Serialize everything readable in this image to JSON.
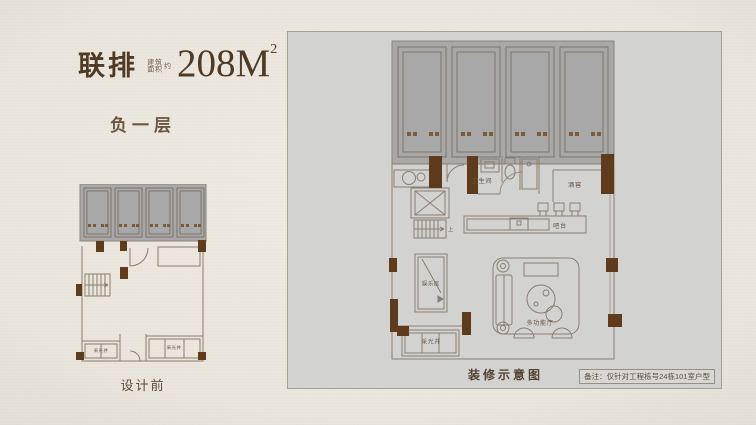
{
  "header": {
    "title": "联排",
    "area_label_line1": "建筑",
    "area_label_line2": "面积",
    "area_label_suffix": "约",
    "area_value": "208M",
    "area_sup": "2",
    "floor": "负一层"
  },
  "before_plan": {
    "caption": "设计前",
    "light_well_left": "采光井",
    "light_well_right": "采光井"
  },
  "after_plan": {
    "caption": "装修示意图",
    "note": "备注：仅针对工程栋号24栋101室户型",
    "rooms": {
      "bathroom": "卫生间",
      "wine_cellar": "酒窖",
      "bar": "吧台",
      "stairs_up": "上",
      "entertainment": "娱乐区",
      "multi_function": "多功能厅",
      "light_well": "采光井"
    }
  },
  "colors": {
    "background": "#e9e5dc",
    "panel_bg": "#d2d2d1",
    "wall_brown": "#5f3b1d",
    "line": "#8b7e6e",
    "garage_gray": "#a8a8a8",
    "text_brown": "#4f3a26"
  }
}
